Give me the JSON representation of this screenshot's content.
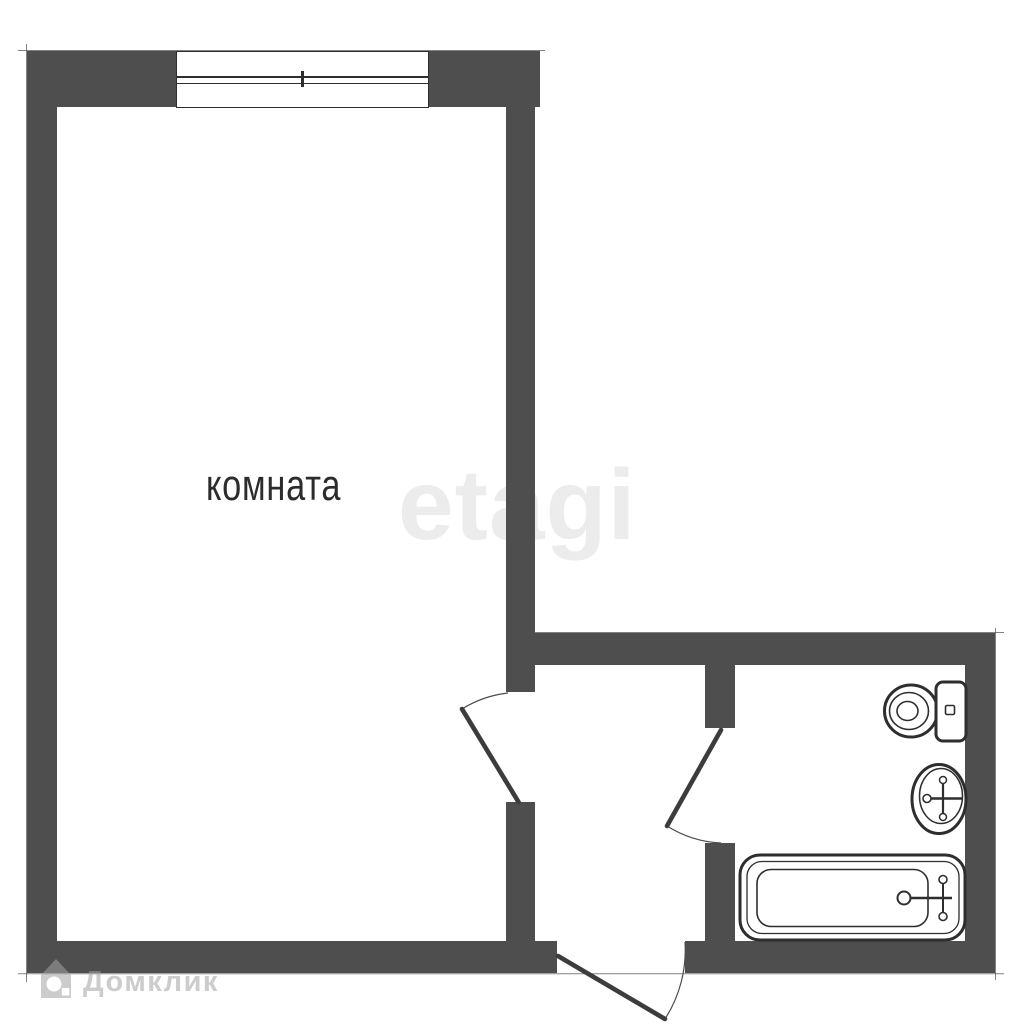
{
  "labels": {
    "room": "комната"
  },
  "watermarks": {
    "etagi": "etagi",
    "domclick": "Домклик"
  },
  "icons": {
    "toilet": "toilet-icon",
    "sink": "sink-icon",
    "bathtub": "bathtub-icon",
    "window": "window-icon",
    "room_door": "room-door",
    "bathroom_door": "bathroom-door",
    "entrance_door": "entrance-door",
    "domclick_logo": "house-logo-icon"
  },
  "colors": {
    "background": "#ffffff",
    "wall": "#4e4e4e",
    "line": "#2e2e2e",
    "door": "#3c3c3c",
    "etagi_wm": "#ececec",
    "domclick_wm": "rgba(163,163,163,0.55)"
  }
}
